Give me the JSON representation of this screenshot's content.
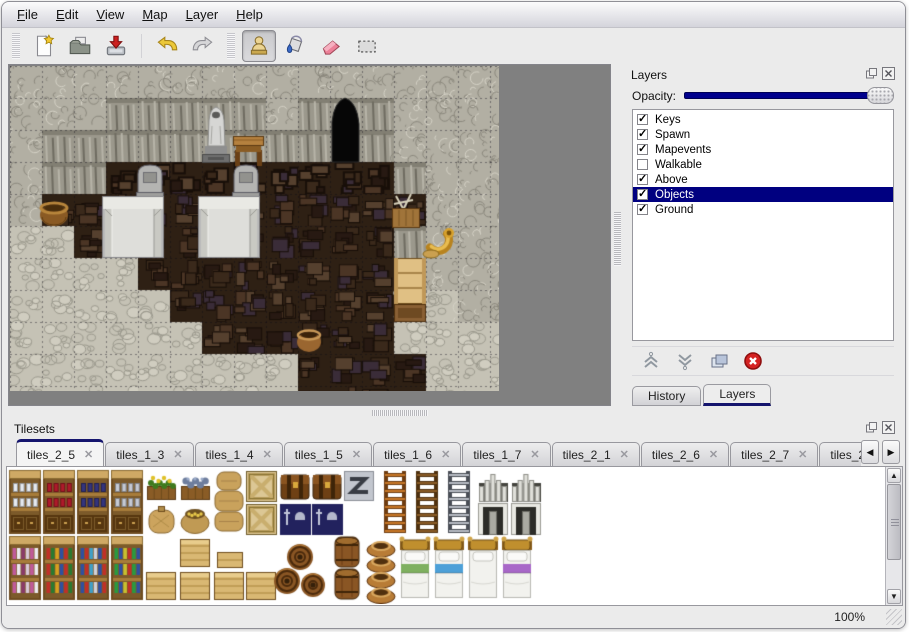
{
  "menu_bar": {
    "items": [
      {
        "label": "File"
      },
      {
        "label": "Edit"
      },
      {
        "label": "View"
      },
      {
        "label": "Map"
      },
      {
        "label": "Layer"
      },
      {
        "label": "Help"
      }
    ]
  },
  "toolbar": {
    "file_buttons": [
      {
        "name": "new-file"
      },
      {
        "name": "open"
      },
      {
        "name": "save"
      }
    ],
    "history_buttons": [
      {
        "name": "undo"
      },
      {
        "name": "redo"
      }
    ],
    "tool_buttons": [
      {
        "name": "stamp",
        "selected": true
      },
      {
        "name": "fill"
      },
      {
        "name": "eraser"
      },
      {
        "name": "select"
      }
    ]
  },
  "layers_panel": {
    "title": "Layers",
    "opacity_label": "Opacity:",
    "opacity_percent": 100,
    "selection_color": "#000080",
    "layers": [
      {
        "name": "Keys",
        "checked": true,
        "selected": false
      },
      {
        "name": "Spawn",
        "checked": true,
        "selected": false
      },
      {
        "name": "Mapevents",
        "checked": true,
        "selected": false
      },
      {
        "name": "Walkable",
        "checked": false,
        "selected": false
      },
      {
        "name": "Above",
        "checked": true,
        "selected": false
      },
      {
        "name": "Objects",
        "checked": true,
        "selected": true
      },
      {
        "name": "Ground",
        "checked": true,
        "selected": false
      }
    ],
    "buttons": [
      "move-layer-up",
      "move-layer-down",
      "duplicate-layer",
      "delete-layer"
    ]
  },
  "dock_tabs": [
    {
      "label": "History",
      "active": false
    },
    {
      "label": "Layers",
      "active": true
    }
  ],
  "tilesets_panel": {
    "title": "Tilesets",
    "tabs": [
      {
        "label": "tiles_2_5",
        "active": true
      },
      {
        "label": "tiles_1_3",
        "active": false
      },
      {
        "label": "tiles_1_4",
        "active": false
      },
      {
        "label": "tiles_1_5",
        "active": false
      },
      {
        "label": "tiles_1_6",
        "active": false
      },
      {
        "label": "tiles_1_7",
        "active": false
      },
      {
        "label": "tiles_2_1",
        "active": false
      },
      {
        "label": "tiles_2_6",
        "active": false
      },
      {
        "label": "tiles_2_7",
        "active": false
      },
      {
        "label": "tiles_2_8",
        "active": false
      }
    ],
    "sprites": [
      {
        "t": "shelf",
        "x": 2,
        "y": 3,
        "c": "#e6eaf0"
      },
      {
        "t": "shelf",
        "x": 36,
        "y": 3,
        "c": "#b01a2a"
      },
      {
        "t": "shelf",
        "x": 70,
        "y": 3,
        "c": "#34347e"
      },
      {
        "t": "shelf",
        "x": 104,
        "y": 3,
        "c": "#c6cad4"
      },
      {
        "t": "planter",
        "x": 138,
        "y": 3,
        "k": "flowers"
      },
      {
        "t": "planter",
        "x": 172,
        "y": 3,
        "k": "stones"
      },
      {
        "t": "sack",
        "x": 138,
        "y": 36
      },
      {
        "t": "sack_open",
        "x": 172,
        "y": 36
      },
      {
        "t": "sack_stack",
        "x": 206,
        "y": 3
      },
      {
        "t": "crate_x",
        "x": 238,
        "y": 3
      },
      {
        "t": "crate_x",
        "x": 238,
        "y": 36
      },
      {
        "t": "chest",
        "x": 272,
        "y": 3
      },
      {
        "t": "chest",
        "x": 304,
        "y": 3
      },
      {
        "t": "ztile",
        "x": 336,
        "y": 3
      },
      {
        "t": "navy",
        "x": 272,
        "y": 36
      },
      {
        "t": "navy",
        "x": 304,
        "y": 36
      },
      {
        "t": "ladder",
        "x": 372,
        "y": 3,
        "k": "orange"
      },
      {
        "t": "ladder",
        "x": 404,
        "y": 3,
        "k": "brown"
      },
      {
        "t": "ladder",
        "x": 436,
        "y": 3,
        "k": "gray"
      },
      {
        "t": "door_top",
        "x": 470,
        "y": 3
      },
      {
        "t": "door_top",
        "x": 503,
        "y": 3
      },
      {
        "t": "door_bottom",
        "x": 470,
        "y": 36
      },
      {
        "t": "door_bottom",
        "x": 503,
        "y": 36
      },
      {
        "t": "bookshelf",
        "x": 2,
        "y": 69,
        "b": [
          "#c05a9a",
          "#eceaf0",
          "#8a3a6a",
          "#d8c8d8"
        ]
      },
      {
        "t": "bookshelf",
        "x": 36,
        "y": 69,
        "b": [
          "#c03028",
          "#2a7a30",
          "#d8a020",
          "#3050a0"
        ]
      },
      {
        "t": "bookshelf",
        "x": 70,
        "y": 69,
        "b": [
          "#3050a0",
          "#c03028",
          "#40a0c8",
          "#d0d0d8"
        ]
      },
      {
        "t": "bookshelf",
        "x": 104,
        "y": 69,
        "b": [
          "#2a9a40",
          "#3050a0",
          "#c8c030",
          "#c03028"
        ]
      },
      {
        "t": "crate",
        "x": 138,
        "y": 102
      },
      {
        "t": "crate_stack",
        "x": 172,
        "y": 69
      },
      {
        "t": "crate_small",
        "x": 210,
        "y": 85
      },
      {
        "t": "crate",
        "x": 206,
        "y": 102
      },
      {
        "t": "crate",
        "x": 238,
        "y": 102
      },
      {
        "t": "barrel_pile",
        "x": 266,
        "y": 72
      },
      {
        "t": "barrels2",
        "x": 324,
        "y": 69
      },
      {
        "t": "pots",
        "x": 358,
        "y": 69
      },
      {
        "t": "bed",
        "x": 392,
        "y": 69,
        "c": "#7fb060"
      },
      {
        "t": "bed",
        "x": 426,
        "y": 69,
        "c": "#4da0d8"
      },
      {
        "t": "bed",
        "x": 460,
        "y": 69,
        "c": ""
      },
      {
        "t": "bed",
        "x": 494,
        "y": 69,
        "c": "#a868c8"
      }
    ]
  },
  "map_view": {
    "tile_size": 32,
    "palette": {
      "wall": "#b2afa3",
      "cliff": "#9b988c",
      "floor": "#2e2014",
      "rubble": "#c5c2b5",
      "opening": "#060606",
      "background": "#808080"
    },
    "grid": [
      "WWWWWWWWWWWWWWW",
      "WWWCCCCCWCBCWWW",
      "WCCCCCCCCCBCWWW",
      "WCCFFFFFFFFFCWW",
      "WFFFFFFFFFFFFWW",
      "RRFFFFFFFFFFCWW",
      "RRRRFFFFFFFFCWW",
      "RRRRRFFFFFFFRRW",
      "RRRRRRFFFFFFRRR",
      "RRRRRRRRRFFFFRR"
    ],
    "objects": [
      {
        "t": "arch",
        "x": 320,
        "y": 30
      },
      {
        "t": "statue",
        "x": 189,
        "y": 34
      },
      {
        "t": "table",
        "x": 222,
        "y": 62
      },
      {
        "t": "grave",
        "x": 124,
        "y": 96
      },
      {
        "t": "grave",
        "x": 220,
        "y": 96
      },
      {
        "t": "platform",
        "x": 92,
        "y": 130
      },
      {
        "t": "platform",
        "x": 188,
        "y": 130
      },
      {
        "t": "basket",
        "x": 29,
        "y": 132
      },
      {
        "t": "pot",
        "x": 285,
        "y": 260
      },
      {
        "t": "crate_tools",
        "x": 379,
        "y": 126
      },
      {
        "t": "horn",
        "x": 411,
        "y": 158
      },
      {
        "t": "cabinet",
        "x": 383,
        "y": 192
      }
    ]
  },
  "status_bar": {
    "zoom_level": "100%"
  }
}
